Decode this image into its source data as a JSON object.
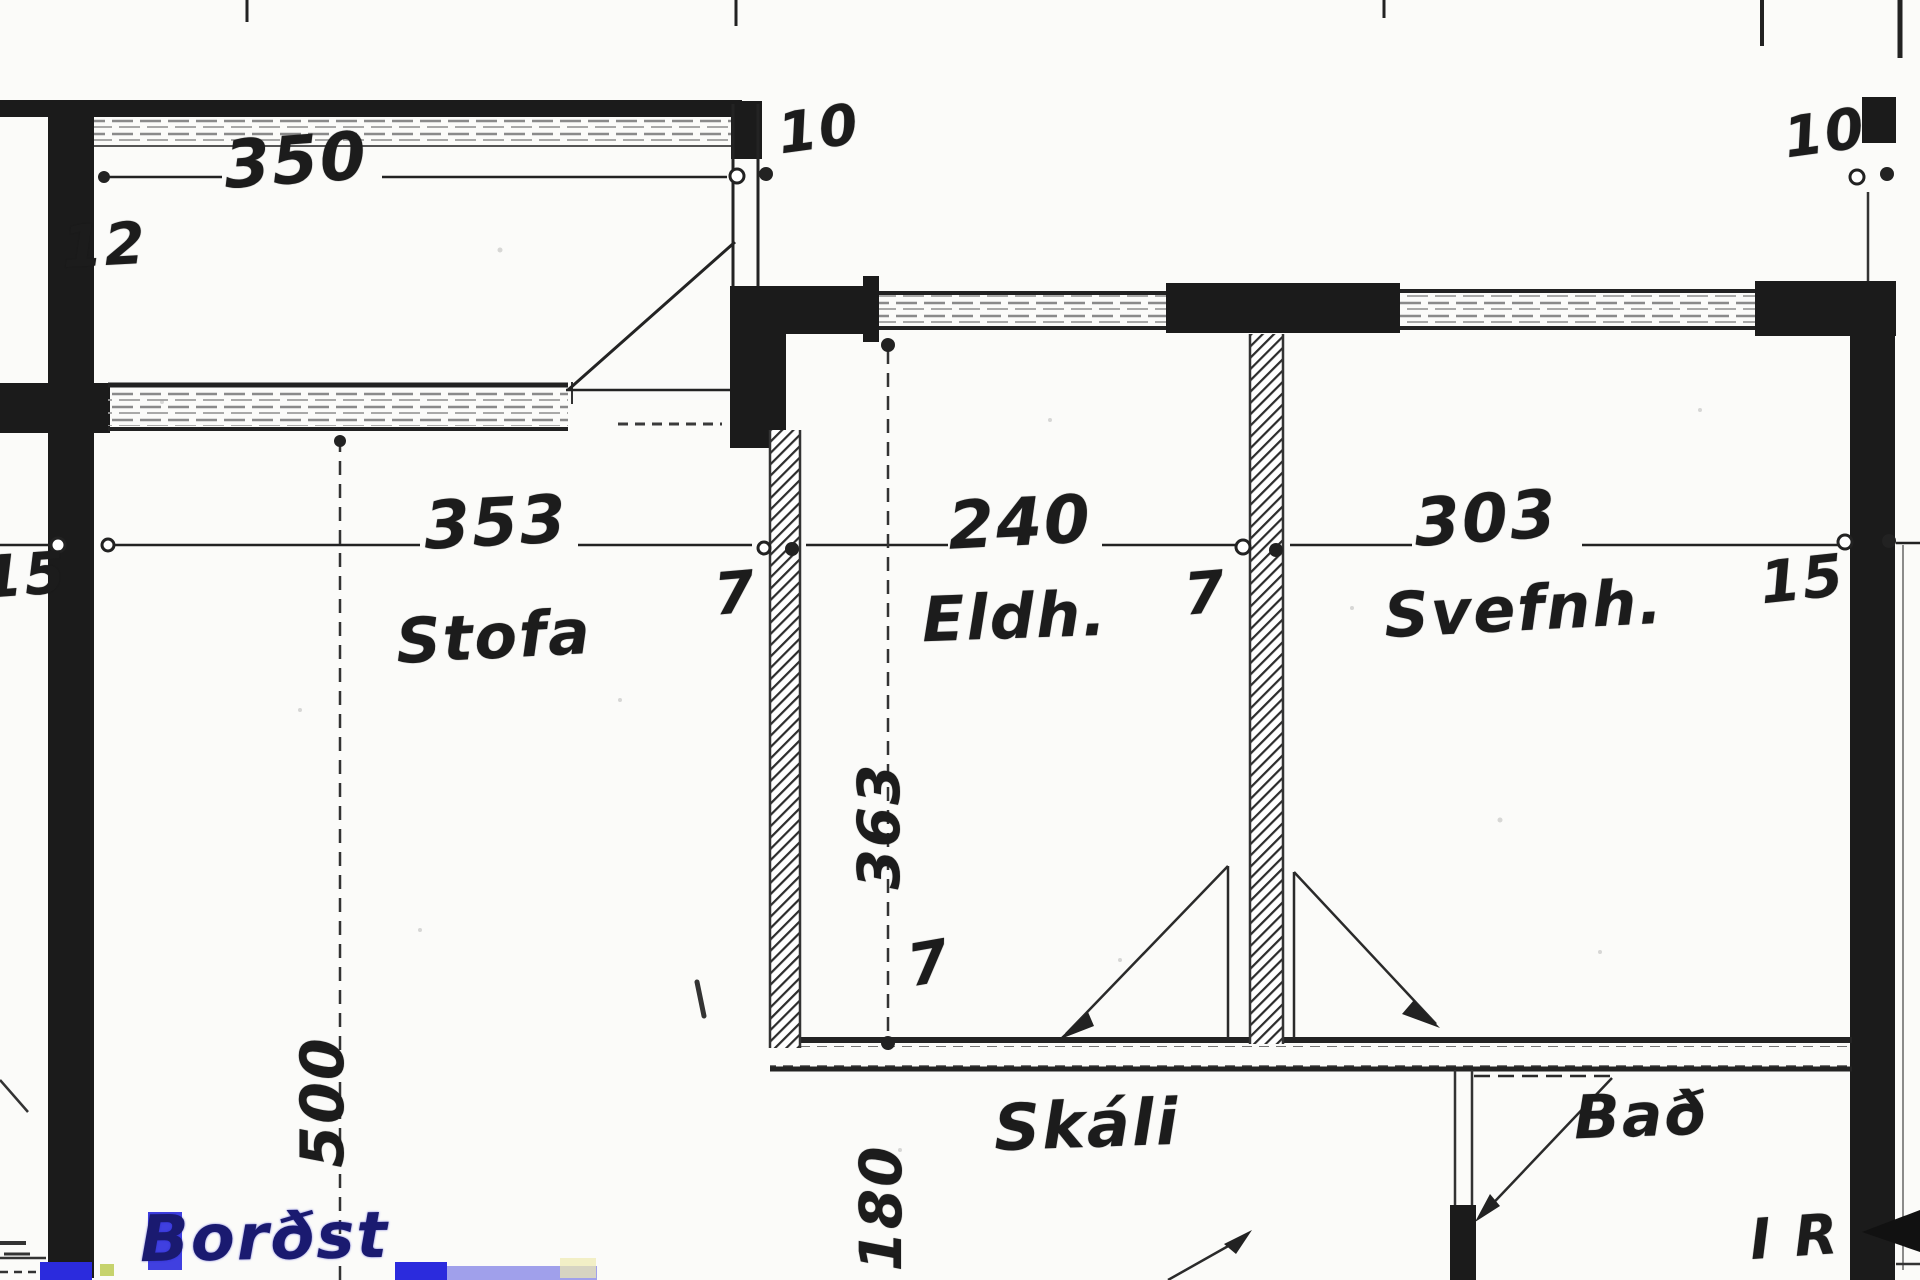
{
  "plan": {
    "type": "scanned architectural floor plan",
    "language": "Icelandic",
    "rooms": [
      {
        "name": "Stofa",
        "meaning": "living room",
        "width_label": "353"
      },
      {
        "name": "Eldh.",
        "meaning": "kitchen",
        "width_label": "240",
        "depth_label": "363"
      },
      {
        "name": "Svefnh.",
        "meaning": "bedroom",
        "width_label": "303"
      },
      {
        "name": "Skáli",
        "meaning": "hall",
        "depth_label": "180"
      },
      {
        "name": "Bað",
        "meaning": "bathroom"
      }
    ],
    "wall_thickness_labels": [
      "15",
      "7",
      "7",
      "15",
      "12"
    ],
    "opening_labels": [
      "10",
      "10"
    ],
    "other_dimensions": [
      "350",
      "500"
    ],
    "handwritten_annotations": [
      "Borðst",
      "I R"
    ]
  },
  "labels": {
    "dim_350": "350",
    "dim_12": "12",
    "dim_10_left": "10",
    "dim_10_right": "10",
    "dim_15_left": "15",
    "dim_353": "353",
    "room_stofa": "Stofa",
    "dim_7_stofa_wall": "7",
    "dim_240": "240",
    "room_eldh": "Eldh.",
    "dim_7_divider_wall": "7",
    "dim_303": "303",
    "room_svefnh": "Svefnh.",
    "dim_15_right": "15",
    "dim_500": "500",
    "dim_363": "363",
    "dim_7_bottom_wall": "7",
    "dim_180": "180",
    "room_skali": "Skáli",
    "room_bad": "Bað",
    "annotation_ir": "I R",
    "annotation_bordst": "Borðst"
  },
  "colors": {
    "ink": "#1b1b1b",
    "window_streak": "#8a8a8a",
    "annotation_blue": "#2b2bdd",
    "paper": "#fbfbf9"
  }
}
